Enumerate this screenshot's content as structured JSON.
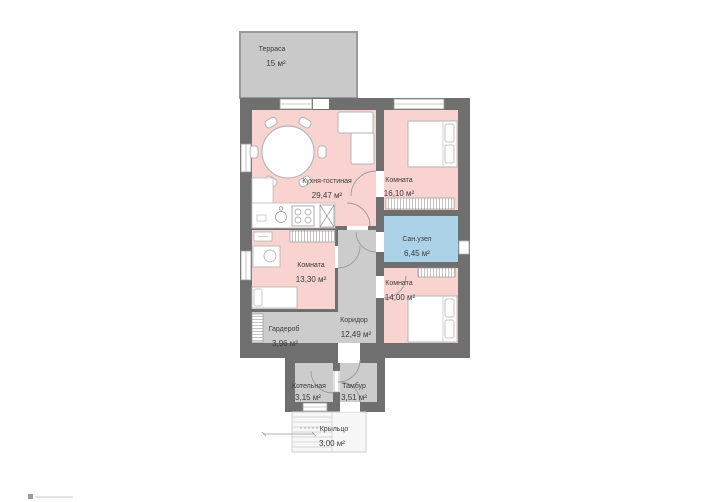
{
  "plan": {
    "type": "floor-plan",
    "rooms": [
      {
        "name": "Терраса",
        "area": "15 м²"
      },
      {
        "name": "Кухня-гостиная",
        "area": "29,47 м²"
      },
      {
        "name": "Комната",
        "area": "16,10 м²"
      },
      {
        "name": "Сан.узел",
        "area": "6,45 м²"
      },
      {
        "name": "Комната",
        "area": "13,30 м²"
      },
      {
        "name": "Комната",
        "area": "14,00 м²"
      },
      {
        "name": "Гардероб",
        "area": "3,96 м²"
      },
      {
        "name": "Коридор",
        "area": "12,49 м²"
      },
      {
        "name": "Котельная",
        "area": "3,15 м²"
      },
      {
        "name": "Тамбур",
        "area": "3,51 м²"
      },
      {
        "name": "Крыльцо",
        "area": "3,00 м²"
      }
    ],
    "colors": {
      "wall": "#6f6f6f",
      "living_room_fill": "#f8d3cf",
      "wet_room_fill": "#abd2e6",
      "utility_fill": "#cccccc",
      "terrace_fill": "#c9c9c9",
      "furniture_stroke": "#b5b5b5",
      "label_text": "#3c3c3c"
    }
  }
}
